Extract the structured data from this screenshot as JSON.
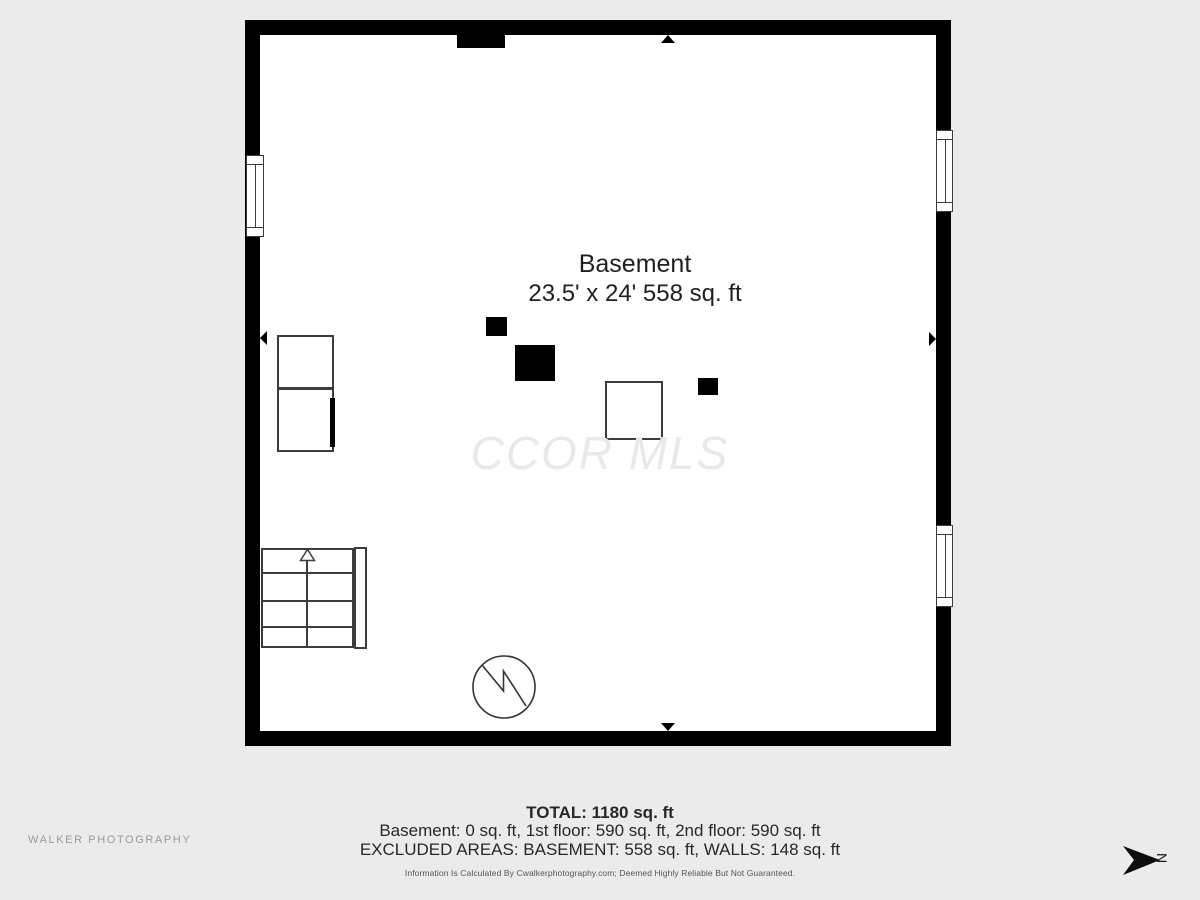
{
  "page": {
    "background_color": "#ebebeb"
  },
  "floor_plan": {
    "room": {
      "name": "Basement",
      "dimensions": "23.5' x 24' 558 sq. ft"
    },
    "watermark": "CCOR MLS",
    "wall_color": "#000000",
    "symbol_line_color": "#3c3c3c"
  },
  "summary": {
    "total": "TOTAL: 1180 sq. ft",
    "floor_breakdown": "Basement: 0 sq. ft, 1st floor: 590 sq. ft, 2nd floor: 590 sq. ft",
    "excluded_areas": "EXCLUDED AREAS: BASEMENT: 558 sq. ft, WALLS: 148 sq. ft",
    "disclaimer": "Information Is Calculated By Cwalkerphotography.com; Deemed Highly Reliable But Not Guaranteed."
  },
  "footer": {
    "photographer": "WALKER PHOTOGRAPHY"
  },
  "compass": {
    "direction_label": "N"
  }
}
